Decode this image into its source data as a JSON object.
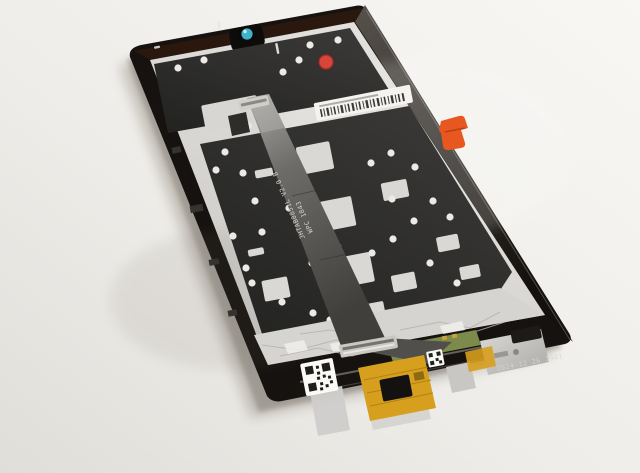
{
  "scene": {
    "subject": "Rear view of a tablet LCD display assembly spare part lying on a white surface"
  },
  "markings": {
    "flex_cable_line1": "JHTAB0851L V2.0 B",
    "flex_cable_line2": "WPC 1843",
    "timestamp_watermark": "2024-12 26 1941"
  },
  "colors": {
    "background_light": "#f7f6f3",
    "background_shade": "#e2e0db",
    "device_frame": "#16120f",
    "back_plate": "#d9d8d4",
    "adhesive": "#2e2d2b",
    "camera_lens": "#3fb3c9",
    "pull_tab": "#e8571f",
    "red_dot_sticker": "#d8453a",
    "kapton_flex": "#d79f1e",
    "pcb_green": "#7c8a4a",
    "foil_tape": "#d6d4d0"
  }
}
